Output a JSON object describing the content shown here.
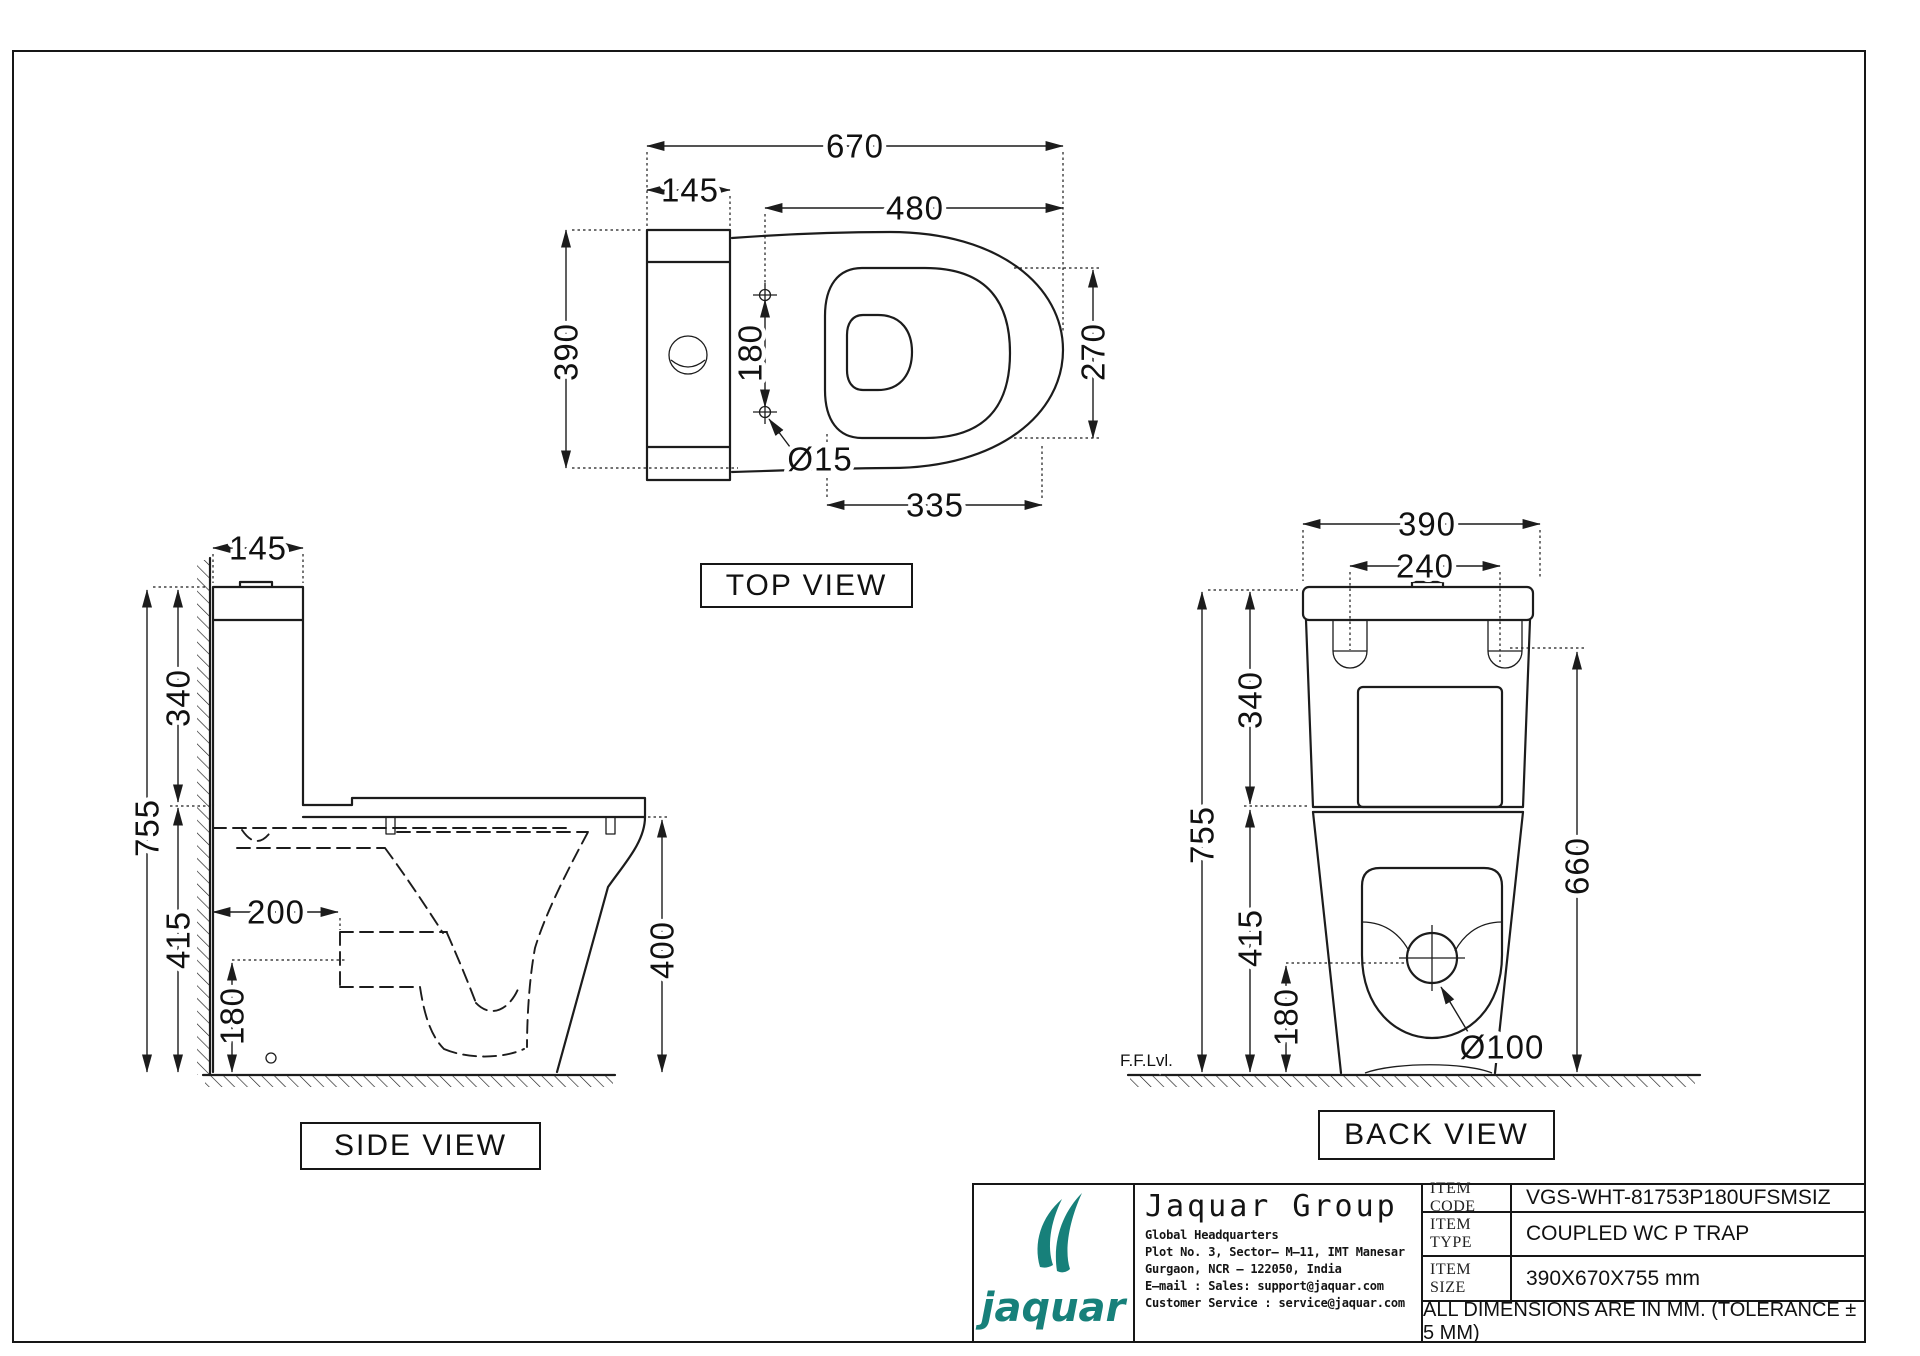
{
  "sheet": {
    "note": "ALL DIMENSIONS ARE IN MM. (TOLERANCE ± 5 MM)"
  },
  "views": {
    "top": {
      "label": "TOP VIEW",
      "dims": {
        "total_depth": "670",
        "cistern_depth": "145",
        "seat_length": "480",
        "overall_width": "390",
        "fixing_hole_gap": "180",
        "seat_inner_width": "270",
        "fixing_hole_dia": "Ø15",
        "front_overhang": "335"
      }
    },
    "side": {
      "label": "SIDE VIEW",
      "dims": {
        "cistern_depth": "145",
        "cistern_height": "340",
        "overall_height": "755",
        "rim_height": "415",
        "trap_offset": "200",
        "trap_height": "180",
        "bowl_front_height": "400"
      }
    },
    "back": {
      "label": "BACK VIEW",
      "floor_level": "F.F.Lvl.",
      "dims": {
        "overall_width": "390",
        "hinge_gap": "240",
        "cistern_height": "340",
        "overall_height": "755",
        "rim_height": "415",
        "outlet_height": "180",
        "hinge_to_floor": "660",
        "outlet_dia": "Ø100"
      }
    }
  },
  "title_block": {
    "logo_word": "jaquar",
    "brand_color": "#17807A",
    "company_name": "Jaquar Group",
    "address": [
      "Global Headquarters",
      "Plot No. 3, Sector– M–11, IMT Manesar",
      "Gurgaon, NCR – 122050, India",
      "E–mail : Sales: support@jaquar.com",
      "Customer Service : service@jaquar.com"
    ],
    "item_code_label": "ITEM CODE",
    "item_code": "VGS-WHT-81753P180UFSMSIZ",
    "item_type_label": "ITEM TYPE",
    "item_type": "COUPLED WC P TRAP",
    "item_size_label": "ITEM SIZE",
    "item_size": "390X670X755 mm",
    "note": "ALL DIMENSIONS ARE IN MM. (TOLERANCE ± 5 MM)"
  }
}
